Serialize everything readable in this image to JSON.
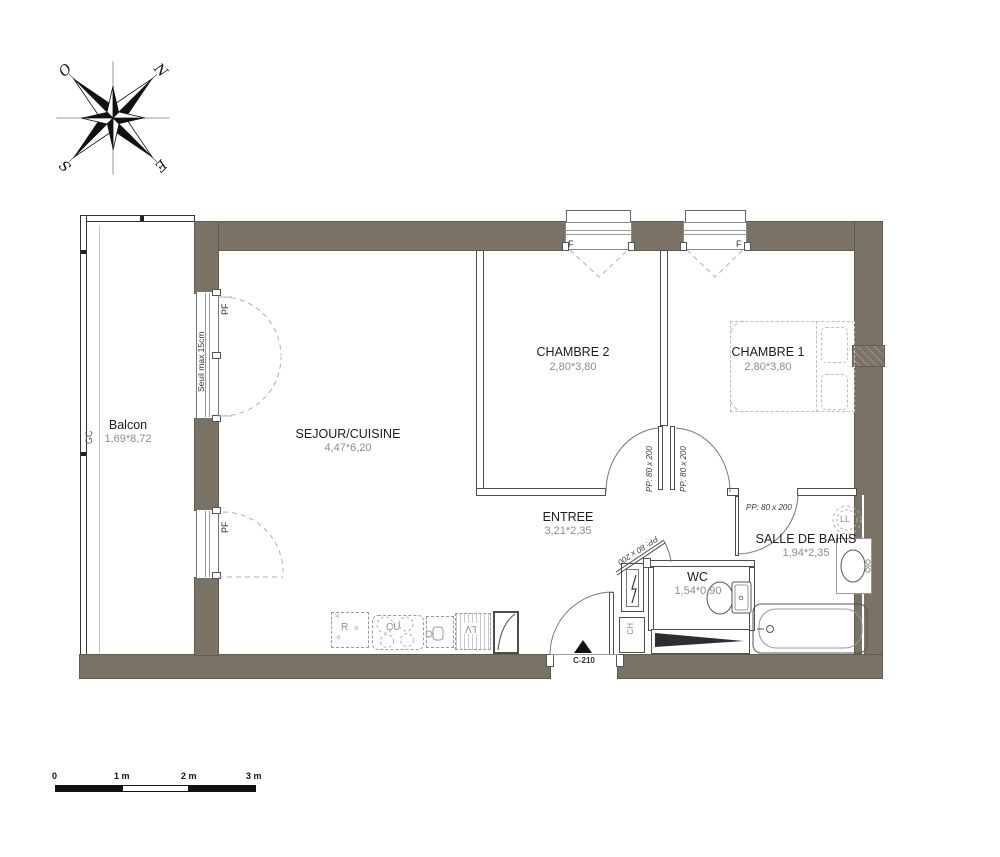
{
  "compass": {
    "n": "N",
    "e": "E",
    "s": "S",
    "o": "O"
  },
  "rooms": {
    "balcon": {
      "name": "Balcon",
      "dim": "1,69*8,72"
    },
    "sejour": {
      "name": "SEJOUR/CUISINE",
      "dim": "4,47*6,20"
    },
    "chambre2": {
      "name": "CHAMBRE 2",
      "dim": "2,80*3,80"
    },
    "chambre1": {
      "name": "CHAMBRE 1",
      "dim": "2,80*3,80"
    },
    "entree": {
      "name": "ENTREE",
      "dim": "3,21*2,35"
    },
    "salle_de_bains": {
      "name": "SALLE DE BAINS",
      "dim": "1,94*2,35"
    },
    "wc": {
      "name": "WC",
      "dim": "1,54*0,90"
    }
  },
  "openings": {
    "window_label": "F",
    "french_door_label": "PF",
    "threshold_note": "Seuil max 15cm",
    "interior_door_size": "PP: 80 x 200",
    "entry_door_ref": "C-210"
  },
  "equipment": {
    "gc": "GC",
    "ch": "CH",
    "ll": "LL",
    "fridge": "R",
    "cooktop": "CU",
    "dishwasher": "LV",
    "snowflake": "✳"
  },
  "scale_bar": {
    "ticks": [
      "0",
      "1 m",
      "2 m",
      "3 m"
    ]
  },
  "colors": {
    "exterior_wall": "#7a7265",
    "dim_text": "#8c8c8c",
    "outline": "#4d4d4d"
  }
}
